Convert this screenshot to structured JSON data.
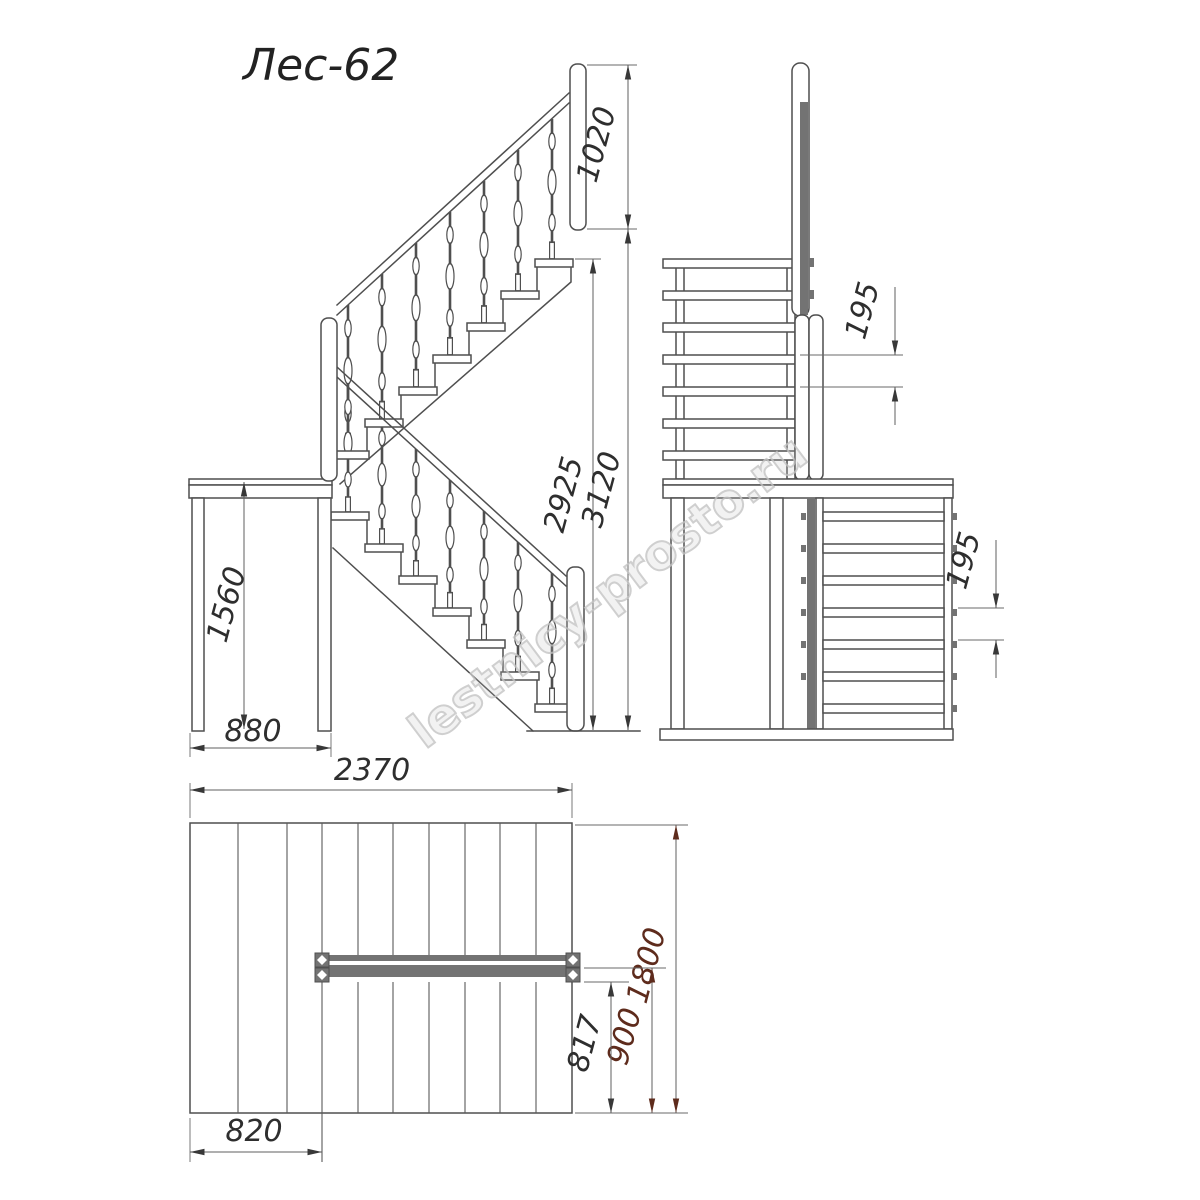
{
  "title": "Лес-62",
  "watermark": "lestnicy-prosto.ru",
  "colors": {
    "drawing_line": "#4f4f4f",
    "dim_line": "#5f5f5f",
    "dim_text": "#2e2e2e",
    "accent_dim_text": "#5e2b1c",
    "dark_fill": "#737373",
    "watermark": "#c4c4c4"
  },
  "dims": {
    "side": {
      "railing_height": "1020",
      "floor_to_top_tread": "2925",
      "total_height": "3120",
      "landing_height": "1560",
      "landing_depth": "880"
    },
    "front": {
      "upper_riser": "195",
      "lower_riser": "195"
    },
    "plan": {
      "total_length": "2370",
      "total_width": "1800",
      "opening_width": "900",
      "flight_width": "817",
      "landing_length": "820"
    }
  }
}
